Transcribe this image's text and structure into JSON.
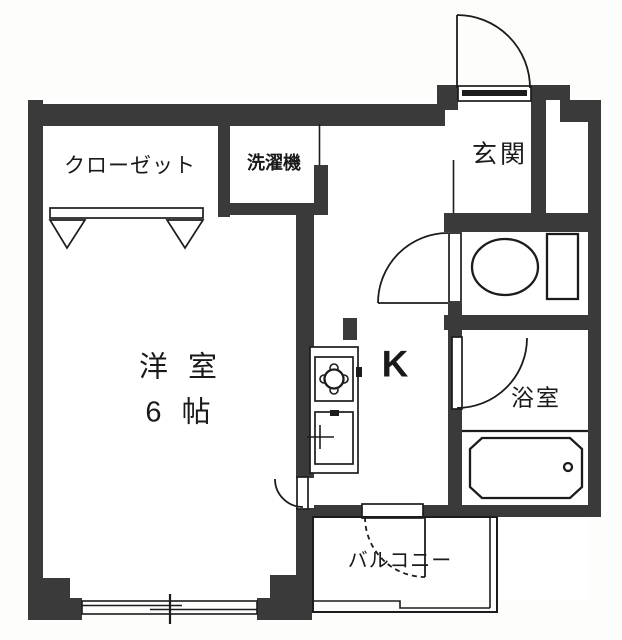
{
  "plan": {
    "type": "apartment-floor-plan",
    "rooms": {
      "closet": {
        "label": "クローゼット"
      },
      "laundry": {
        "label": "洗濯機"
      },
      "entrance": {
        "label": "玄関"
      },
      "main_room": {
        "label": "洋 室",
        "size": "6 帖"
      },
      "kitchen": {
        "label": "K"
      },
      "bathroom": {
        "label": "浴室"
      },
      "balcony": {
        "label": "バルコニー"
      }
    },
    "colors": {
      "wall": "#3a3a3a",
      "line": "#1c1c1c",
      "background": "#ffffff"
    }
  }
}
